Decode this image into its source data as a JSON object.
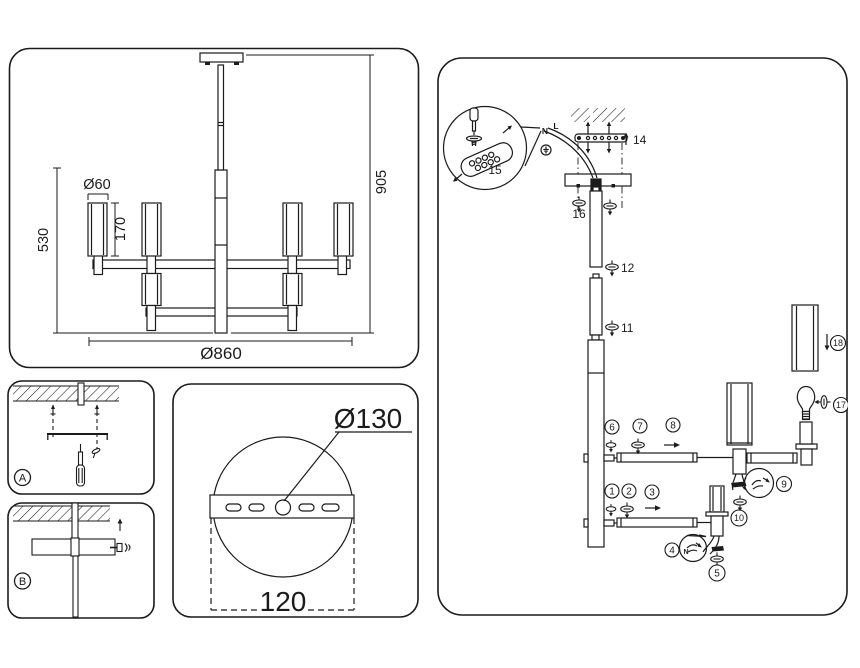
{
  "colors": {
    "line": "#1b1b1b",
    "background": "#ffffff"
  },
  "front_view": {
    "shade_diameter": "Ø60",
    "shade_height": "170",
    "body_height": "530",
    "overall_height": "905",
    "overall_diameter": "Ø860"
  },
  "detail_a": {
    "label": "A"
  },
  "detail_b": {
    "label": "B"
  },
  "canopy_detail": {
    "canopy_diameter": "Ø130",
    "bracket_width": "120"
  },
  "assembly": {
    "wires": {
      "n": "N",
      "l": "L"
    },
    "balloon4_wire": "N",
    "labels": {
      "p14": "14",
      "p15": "15",
      "p16": "16",
      "p12": "12",
      "p11": "11"
    },
    "steps": {
      "s1": "1",
      "s2": "2",
      "s3": "3",
      "s4": "4",
      "s5": "5",
      "s6": "6",
      "s7": "7",
      "s8": "8",
      "s9": "9",
      "s10": "10",
      "s17": "17",
      "s18": "18"
    }
  }
}
